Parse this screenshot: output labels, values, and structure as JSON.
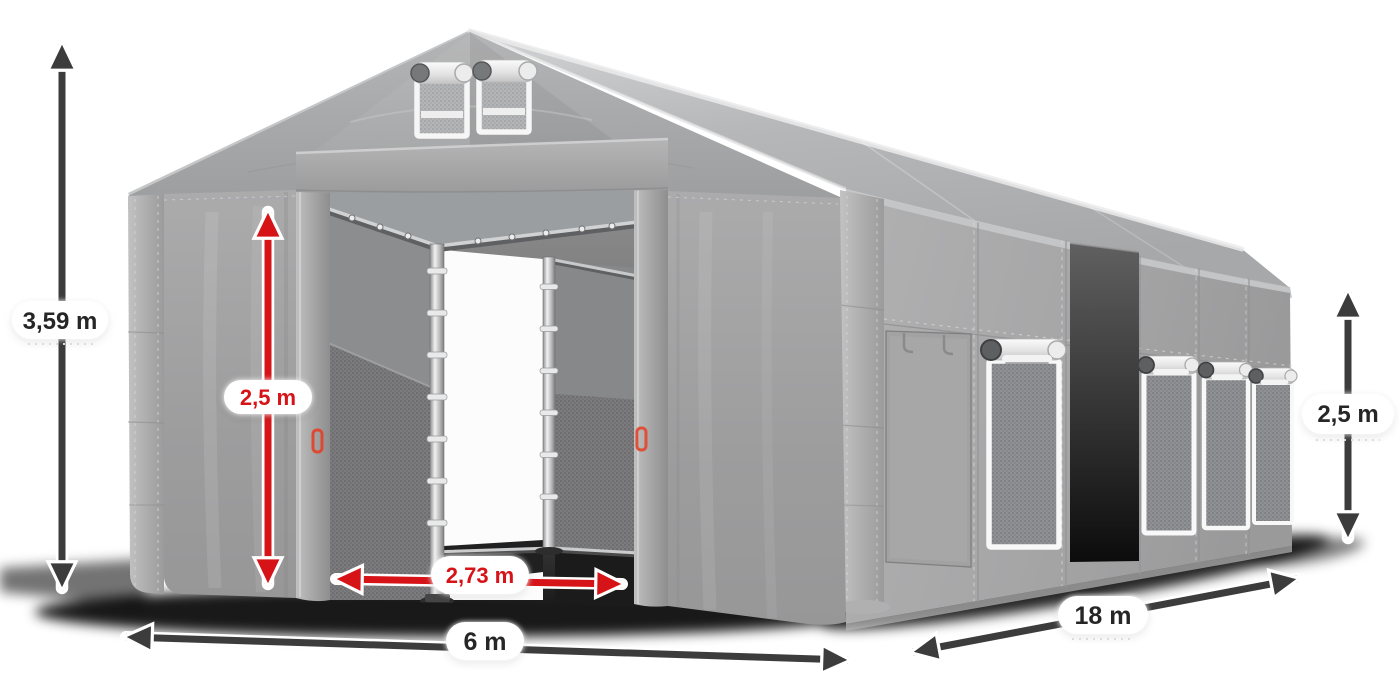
{
  "scene": {
    "description": "Grey storage tent 6x18 m with open front gates, side windows and dimension arrows",
    "background_color": "#ffffff"
  },
  "colors": {
    "arrow_dark": "#3c3c3c",
    "arrow_red": "#d61418",
    "label_text_dark": "#262626",
    "label_text_red": "#d61418",
    "tent_fabric": "#a3a3a4",
    "roof": "#bcbdbe"
  },
  "dimensions": {
    "total_height": {
      "value": "3,59 m",
      "color": "#262626"
    },
    "door_height": {
      "value": "2,5 m",
      "color": "#d61418"
    },
    "door_width": {
      "value": "2,73 m",
      "color": "#d61418"
    },
    "front_width": {
      "value": "6 m",
      "color": "#262626"
    },
    "side_length": {
      "value": "18 m",
      "color": "#262626"
    },
    "wall_height": {
      "value": "2,5 m",
      "color": "#262626"
    }
  }
}
